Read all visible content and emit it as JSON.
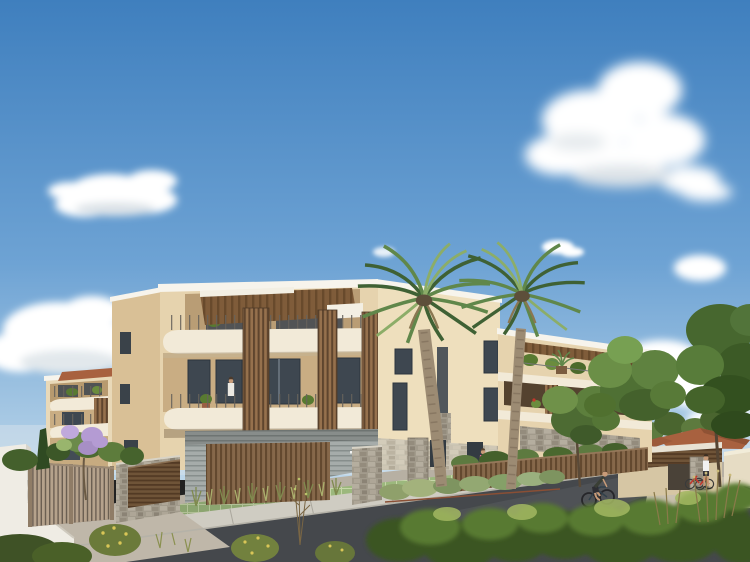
{
  "meta": {
    "width": 750,
    "height": 562,
    "kind": "photorealistic architectural exterior rendering",
    "text_content": "none (image contains no readable text or UI elements)"
  },
  "scene": {
    "description": "Daytime architectural rendering of a modern three-storey cream apartment residence with curved white balcony bands, vertical timber brise-soleil screens and rooftop pergola terraces; two tall fan palms stand in front; landscaped street with grass-grid parking, timber gate and stone walls, a cyclist on the road, pedestrians, red bicycles at a rack, Mediterranean shrubs in the foreground under a blue sky with scattered cumulus clouds.",
    "objects": {
      "sky": "clear blue sky, lighter toward horizon",
      "clouds": "large cumulus upper right, smaller cloud upper left, low bright clouds on left and right horizon",
      "main_building": "3-storey cream render, curved balcony fascias, timber slat screens, rooftop pergolas, grey timber-clad ground floor with stone accents",
      "secondary_building": "2-storey cream building at left with terracotta roof cap and curved balconies",
      "annex": "single-storey garage annex with timber slat band and stone pillar at right",
      "background_houses": "terracotta tiled roofs among trees at far right",
      "palm_trees": "two tall fan palms in front of the facade",
      "street_trees": "leafy green trees at right, small purple-blossom tree by the left gate",
      "gate_and_walls": "timber slat double gate, white rendered walls, dry-stone low walls with timber panels",
      "fence": "timber slat fence along the right pavement with hedge behind",
      "parking": "green grass-grid pavers in front of the building",
      "road_and_sidewalk": "asphalt street curving across the foreground with light concrete pavement",
      "people": "one cyclist, one pedestrian near red bikes, woman in pink at entrance, resident on balcony, figure on roof terrace",
      "foreground": "wild olive-green shrubs and yellow-flowering grasses"
    },
    "counts": {
      "storeys_main": 3,
      "palm_trees": 2,
      "cyclists": 1,
      "pedestrians": 2,
      "balcony_figures": 2,
      "parked_red_bikes": 2
    }
  },
  "palette": {
    "sky_top": "#3f7fbe",
    "sky_mid": "#6ea3d4",
    "sky_horizon": "#bdd7ea",
    "cloud": "#ffffff",
    "cloud_shadow": "#dde3e8",
    "coping_white": "#f7f4ec",
    "balcony_white": "#f2ead8",
    "wall_cream_lit": "#eedfbd",
    "wall_cream": "#e6d3ae",
    "wall_shadow": "#c9ad83",
    "wall_end": "#d9c096",
    "secondary_wall": "#e9d9b8",
    "annex_wall": "#d6c6a4",
    "pergola_brown": "#7f5c3a",
    "wood_slat": "#8a6a4a",
    "fence_wood": "#7d6040",
    "gate_gap": "#6b5f52",
    "gate_wood": "#b5a28c",
    "stone": "#a59e8f",
    "clad_gray": "#a0a7a5",
    "roof_tile": "#a8613f",
    "glass_dark": "#3e4750",
    "ground": "#b7b0a3",
    "road": "#45484c",
    "sidewalk": "#cfccc2",
    "driveway": "#bfb7a9",
    "paver_green": "#9cb87d",
    "white_wall": "#efece4",
    "foliage_dark": "#3a5524",
    "foliage_mid": "#587a31",
    "foliage_light": "#7da04b",
    "palm_dark": "#3f6134",
    "palm_mid": "#60874a",
    "palm_light": "#8cad68",
    "trunk": "#9c8b73",
    "grass_olive": "#8a904f",
    "flower_yellow": "#d9c657",
    "blossom_purple": "#b49bd3",
    "skin": "#c89b78",
    "accent_pink": "#e8639e",
    "bike_red": "#c2372c"
  }
}
